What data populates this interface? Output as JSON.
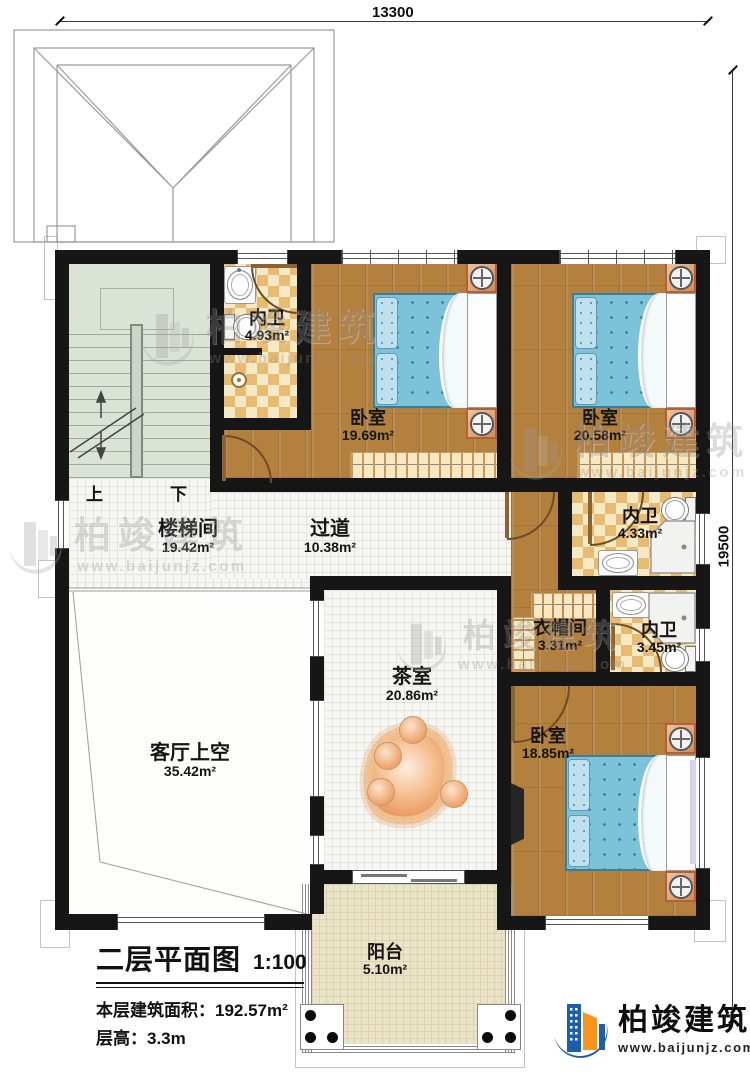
{
  "dimensions": {
    "top": "13300",
    "right": "19500"
  },
  "rooms": {
    "bath1": {
      "name": "内卫",
      "area": "4.93m²"
    },
    "bedroom1": {
      "name": "卧室",
      "area": "19.69m²"
    },
    "bedroom2": {
      "name": "卧室",
      "area": "20.58m²"
    },
    "bath2": {
      "name": "内卫",
      "area": "4.33m²"
    },
    "stairhall": {
      "name": "楼梯间",
      "area": "19.42m²"
    },
    "corridor": {
      "name": "过道",
      "area": "10.38m²"
    },
    "cloakroom": {
      "name": "衣帽间",
      "area": "3.31m²"
    },
    "bath3": {
      "name": "内卫",
      "area": "3.45m²"
    },
    "tearoom": {
      "name": "茶室",
      "area": "20.86m²"
    },
    "livingvoid": {
      "name": "客厅上空",
      "area": "35.42m²"
    },
    "bedroom3": {
      "name": "卧室",
      "area": "18.85m²"
    },
    "balcony": {
      "name": "阳台",
      "area": "5.10m²"
    }
  },
  "stairs": {
    "up": "上",
    "down": "下"
  },
  "title_block": {
    "title": "二层平面图",
    "scale": "1:100",
    "area_label": "本层建筑面积：",
    "area_value": "192.57m²",
    "height_label": "层高：",
    "height_value": "3.3m"
  },
  "watermark": {
    "brand": "柏竣建筑",
    "url": "www.baijunjz.com"
  },
  "logo": {
    "brand": "柏竣建筑",
    "url": "www.baijunjz.com"
  },
  "colors": {
    "wall": "#161616",
    "wood_floor": "#b3803e",
    "tile_checker": "#e8bb73",
    "bed_blue": "#7cc2d8",
    "brand_blue": "#1c5fa8",
    "brand_orange": "#f7941d"
  }
}
